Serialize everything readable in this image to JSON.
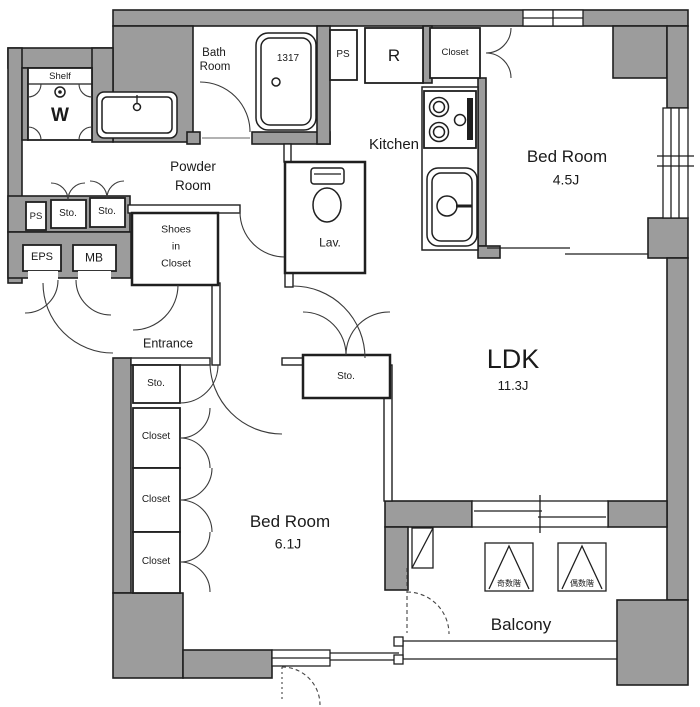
{
  "colors": {
    "wall": "#9c9c9c",
    "line": "#1f1f1f",
    "bg": "#ffffff",
    "text": "#1a1a1a"
  },
  "labels": {
    "shelf": "Shelf",
    "washer": "W",
    "bath_room_line1": "Bath",
    "bath_room_line2": "Room",
    "bathtub_size": "1317",
    "pipe_space_top": "PS",
    "refrigerator": "R",
    "closet_top": "Closet",
    "bedroom1_name": "Bed Room",
    "bedroom1_size": "4.5J",
    "kitchen": "Kitchen",
    "powder_line1": "Powder",
    "powder_line2": "Room",
    "lavatory": "Lav.",
    "pipe_space_left": "PS",
    "storage_small1": "Sto.",
    "storage_small2": "Sto.",
    "eps": "EPS",
    "meter_box": "MB",
    "shoes_line1": "Shoes",
    "shoes_line2": "in",
    "shoes_line3": "Closet",
    "entrance": "Entrance",
    "storage_mid": "Sto.",
    "ldk_name": "LDK",
    "ldk_size": "11.3J",
    "storage_col": "Sto.",
    "closet_col1": "Closet",
    "closet_col2": "Closet",
    "closet_col3": "Closet",
    "bedroom2_name": "Bed Room",
    "bedroom2_size": "6.1J",
    "balcony": "Balcony",
    "hatch_odd": "奇数階",
    "hatch_even": "偶数階"
  }
}
